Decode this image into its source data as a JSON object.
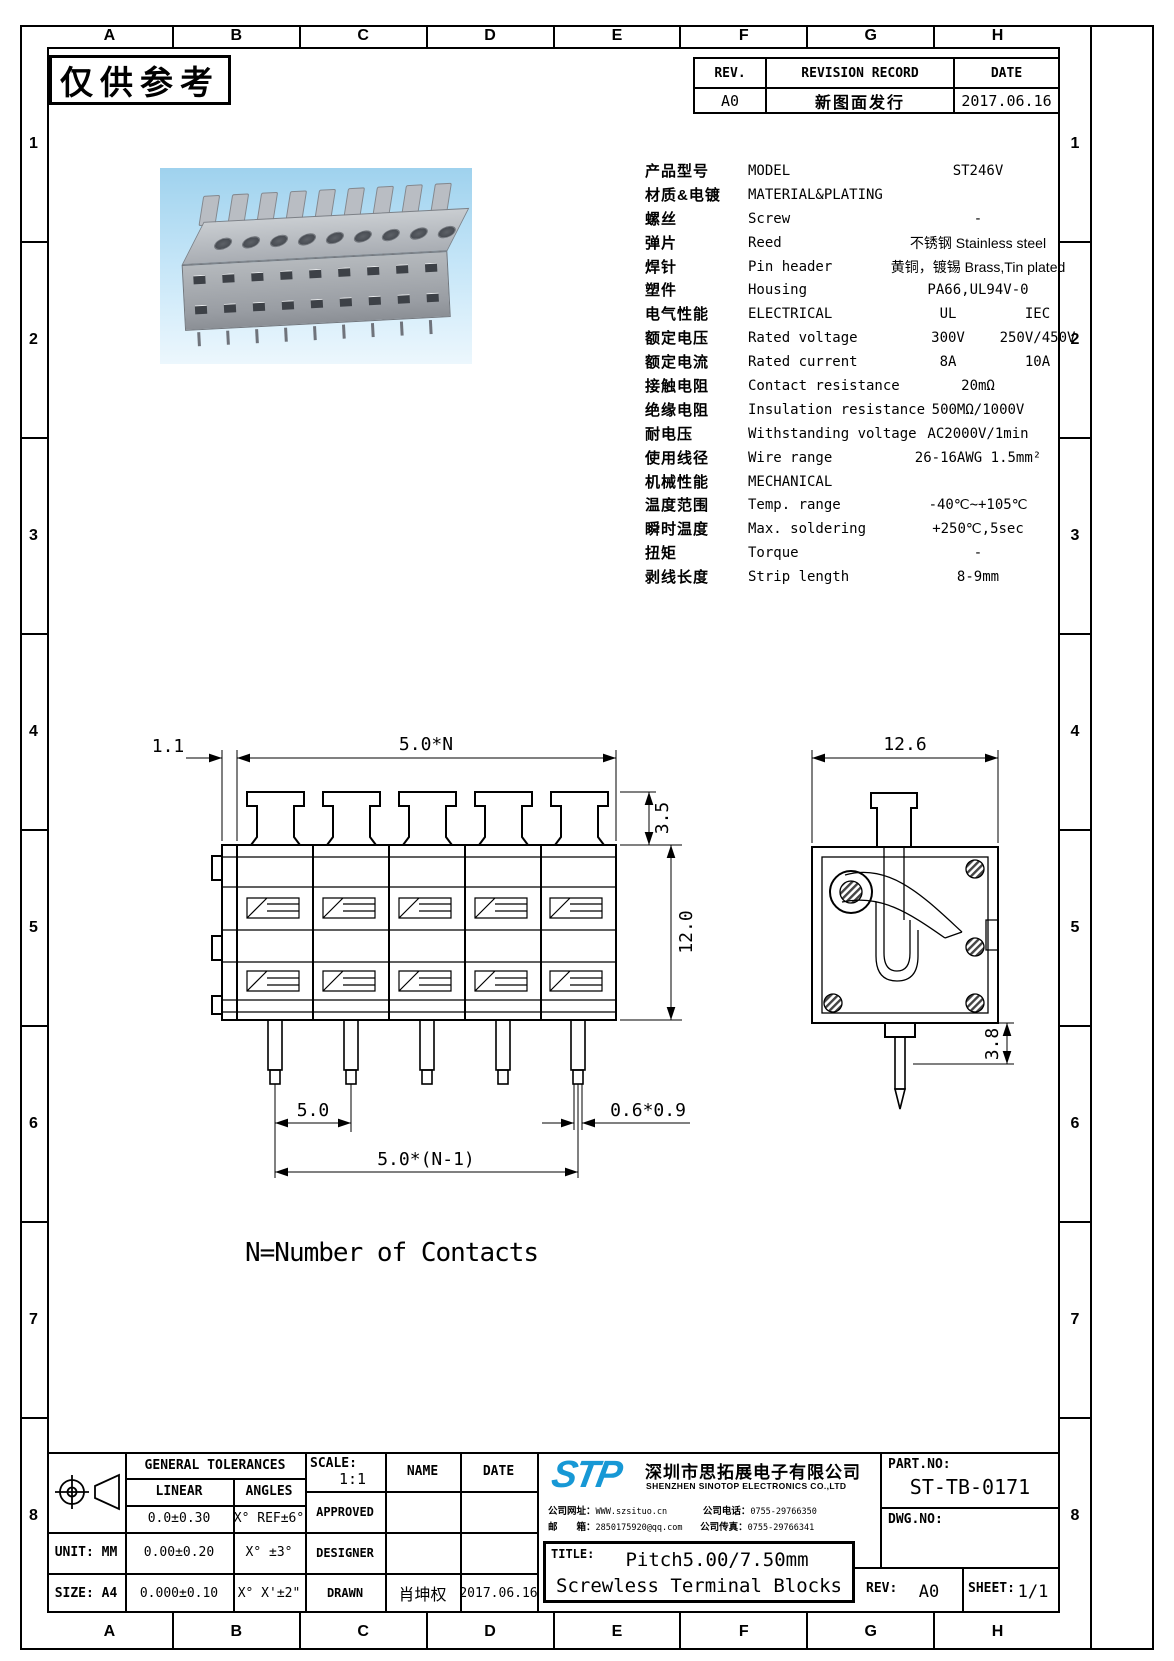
{
  "frame": {
    "cols": [
      "A",
      "B",
      "C",
      "D",
      "E",
      "F",
      "G",
      "H"
    ],
    "rows": [
      "1",
      "2",
      "3",
      "4",
      "5",
      "6",
      "7",
      "8"
    ]
  },
  "stamp": "仅供参考",
  "revision": {
    "rev_h": "REV.",
    "record_h": "REVISION RECORD",
    "date_h": "DATE",
    "rev": "A0",
    "record": "新图面发行",
    "date": "2017.06.16"
  },
  "spec": {
    "rows": [
      {
        "cn": "产品型号",
        "en": "MODEL",
        "v": "ST246V"
      },
      {
        "cn": "材质&电镀",
        "en": "MATERIAL&PLATING",
        "v": ""
      },
      {
        "cn": "螺丝",
        "en": "Screw",
        "v": "-"
      },
      {
        "cn": "弹片",
        "en": "Reed",
        "v": "不锈钢 Stainless steel"
      },
      {
        "cn": "焊针",
        "en": "Pin header",
        "v": "黄铜，镀锡 Brass,Tin plated"
      },
      {
        "cn": "塑件",
        "en": "Housing",
        "v": "PA66,UL94V-0"
      },
      {
        "cn": "电气性能",
        "en": "ELECTRICAL",
        "v1": "UL",
        "v2": "IEC"
      },
      {
        "cn": "额定电压",
        "en": "Rated voltage",
        "v1": "300V",
        "v2": "250V/450V"
      },
      {
        "cn": "额定电流",
        "en": "Rated current",
        "v1": "8A",
        "v2": "10A"
      },
      {
        "cn": "接触电阻",
        "en": "Contact resistance",
        "v": "20mΩ"
      },
      {
        "cn": "绝缘电阻",
        "en": "Insulation resistance",
        "v": "500MΩ/1000V"
      },
      {
        "cn": "耐电压",
        "en": "Withstanding voltage",
        "v": "AC2000V/1min"
      },
      {
        "cn": "使用线径",
        "en": "Wire range",
        "v": "26-16AWG 1.5mm²"
      },
      {
        "cn": "机械性能",
        "en": "MECHANICAL",
        "v": ""
      },
      {
        "cn": "温度范围",
        "en": "Temp. range",
        "v": "-40℃~+105℃"
      },
      {
        "cn": "瞬时温度",
        "en": "Max. soldering",
        "v": "+250℃,5sec"
      },
      {
        "cn": "扭矩",
        "en": "Torque",
        "v": "-"
      },
      {
        "cn": "剥线长度",
        "en": "Strip length",
        "v": "8-9mm"
      }
    ]
  },
  "drawing": {
    "front": {
      "d_offset": "1.1",
      "d_overall": "5.0*N",
      "d_tab_h": "3.5",
      "d_body_h": "12.0",
      "d_pitch": "5.0",
      "d_span": "5.0*(N-1)",
      "d_pin": "0.6*0.9"
    },
    "side": {
      "d_width": "12.6",
      "d_pin_len": "3.8"
    },
    "note": "N=Number of Contacts"
  },
  "titleblock": {
    "general_tolerances": "GENERAL TOLERANCES",
    "linear": "LINEAR",
    "angles": "ANGLES",
    "tol": [
      [
        "0.0±0.30",
        "X° REF±6°"
      ],
      [
        "0.00±0.20",
        "X° ±3°"
      ],
      [
        "0.000±0.10",
        "X° X'±2\""
      ]
    ],
    "unit_label": "UNIT: MM",
    "size_label": "SIZE: A4",
    "scale_label": "SCALE:",
    "scale": "1:1",
    "name_h": "NAME",
    "date_h": "DATE",
    "approved": "APPROVED",
    "designer": "DESIGNER",
    "drawn": "DRAWN",
    "drawn_name": "肖坤权",
    "drawn_date": "2017.06.16",
    "company": {
      "logo": "STP",
      "cn": "深圳市思拓展电子有限公司",
      "en": "SHENZHEN SINOTOP ELECTRONICS CO.,LTD",
      "web_l": "公司网址：",
      "web": "WWW.szsituo.cn",
      "tel_l": "公司电话：",
      "tel": "0755-29766350",
      "mail_l": "邮　　箱：",
      "mail": "2850175920@qq.com",
      "fax_l": "公司传真：",
      "fax": "0755-29766341"
    },
    "title_l": "TITLE:",
    "title1": "Pitch5.00/7.50mm",
    "title2": "Screwless Terminal Blocks",
    "part_l": "PART.NO:",
    "part": "ST-TB-0171",
    "dwg_l": "DWG.NO:",
    "rev_l": "REV:",
    "rev": "A0",
    "sheet_l": "SHEET:",
    "sheet": "1/1"
  }
}
